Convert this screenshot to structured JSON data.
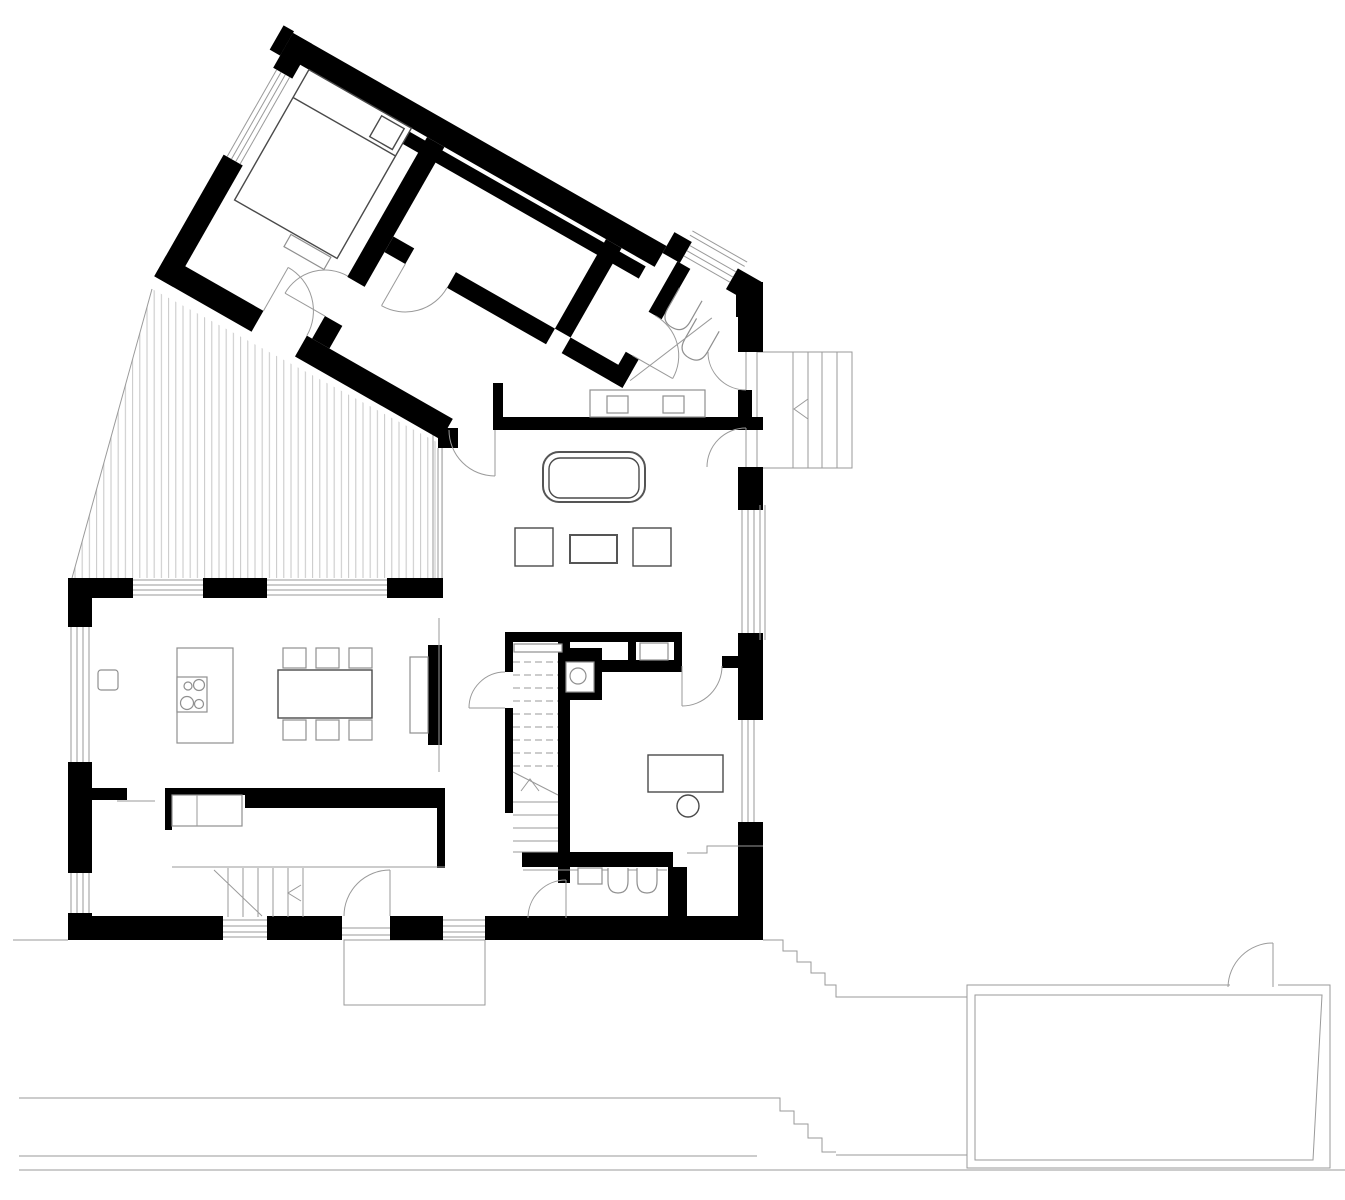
{
  "title": "House ground-floor architectural plan",
  "colors": {
    "background": "#ffffff",
    "walls": "#000000",
    "thin_lines": "#9a9a9a",
    "hatch": "#c6c6c6",
    "furniture": "#4a4a4a"
  },
  "plan": {
    "rooms": [
      "bedroom",
      "room-2",
      "room-3",
      "cloakroom",
      "entry-hall",
      "living-room",
      "dining-kitchen",
      "stair-hall",
      "wc",
      "study",
      "bathroom",
      "pantry",
      "mudroom"
    ],
    "outdoor": [
      "wood-deck-terrace",
      "entry-landing-steps",
      "garden-steps",
      "pool",
      "lower-terrace"
    ],
    "furniture": {
      "bed_count": 1,
      "sofa_count": 1,
      "coffee_tables": 3,
      "dining_chairs": 6,
      "cooktop_burners": 4,
      "bathroom_basins": 2,
      "wardrobe_units": 2,
      "desk_count": 1,
      "kitchen_island": 1,
      "sideboards": 3
    },
    "stairs": {
      "main_stair_location": "center",
      "entry_steps_direction": "up-left-chevron",
      "cellar_steps_direction": "left-chevron"
    }
  }
}
